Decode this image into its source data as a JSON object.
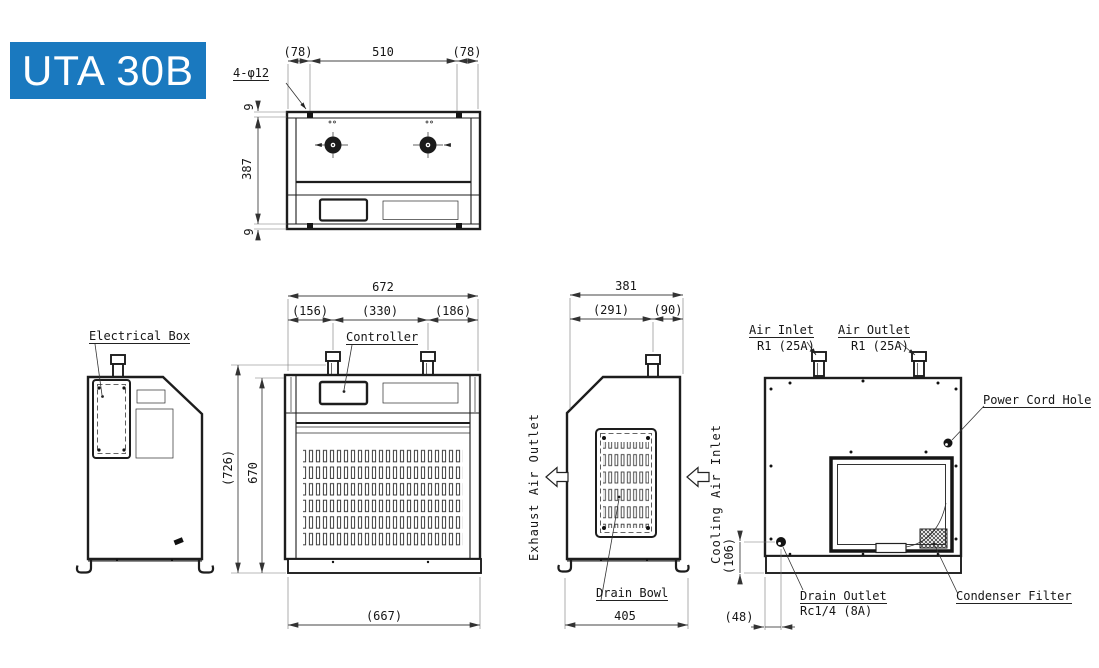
{
  "title": "UTA 30B",
  "colors": {
    "accent": "#1a79bf",
    "ink": "#1d1d1d"
  },
  "top_view": {
    "hole_note": "4-φ12",
    "dim_left_flange": "(78)",
    "dim_hole_pitch": "510",
    "dim_right_flange": "(78)",
    "dim_edge_top": "9",
    "dim_depth": "387",
    "dim_edge_bottom": "9"
  },
  "front_view": {
    "controller_label": "Controller",
    "dim_width": "672",
    "dim_seg_left": "(156)",
    "dim_seg_center": "(330)",
    "dim_seg_right": "(186)",
    "dim_height_overall": "(726)",
    "dim_height_body": "670",
    "dim_base_width": "(667)"
  },
  "left_view": {
    "electrical_box_label": "Electrical Box"
  },
  "side_view": {
    "dim_depth": "381",
    "dim_seg_front": "(291)",
    "dim_seg_rear": "(90)",
    "dim_base_depth": "405",
    "exhaust_label": "Exhaust Air Outlet",
    "cooling_label": "Cooling Air Inlet",
    "drain_bowl_label": "Drain Bowl"
  },
  "rear_view": {
    "air_inlet_label": "Air Inlet",
    "air_inlet_spec": "R1 (25A)",
    "air_outlet_label": "Air Outlet",
    "air_outlet_spec": "R1 (25A)",
    "power_cord_label": "Power Cord Hole",
    "drain_outlet_label": "Drain Outlet",
    "drain_outlet_spec": "Rc1/4 (8A)",
    "condenser_filter_label": "Condenser Filter",
    "dim_drain_height": "(106)",
    "dim_drain_offset": "(48)"
  }
}
